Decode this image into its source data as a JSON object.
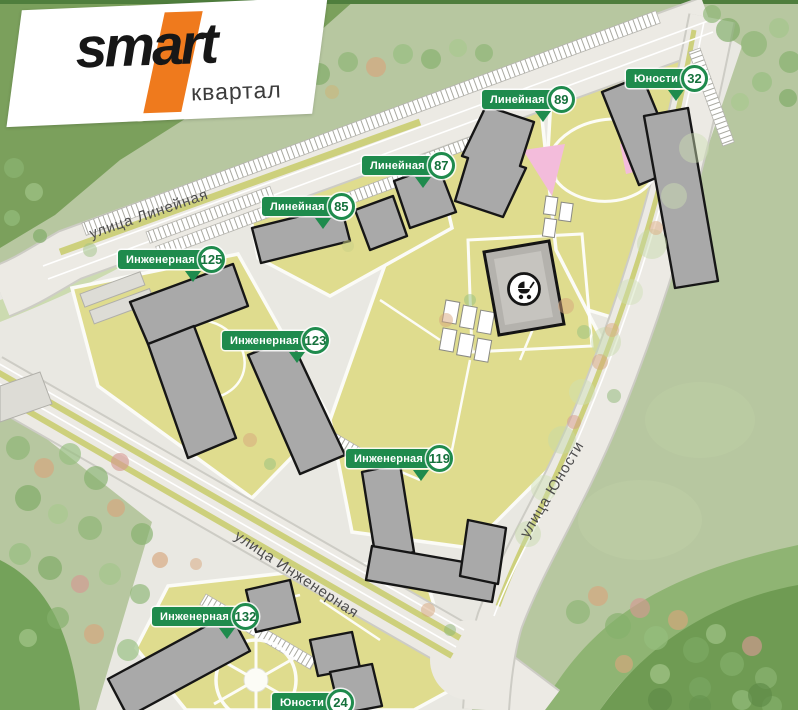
{
  "logo": {
    "brand": "smart",
    "sub": "квартал"
  },
  "markers": [
    {
      "street": "Линейная",
      "number": "89"
    },
    {
      "street": "Юности",
      "number": "32"
    },
    {
      "street": "Линейная",
      "number": "87"
    },
    {
      "street": "Линейная",
      "number": "85"
    },
    {
      "street": "Инженерная",
      "number": "125"
    },
    {
      "street": "Инженерная",
      "number": "123"
    },
    {
      "street": "Инженерная",
      "number": "119"
    },
    {
      "street": "Инженерная",
      "number": "132"
    },
    {
      "street": "Юности",
      "number": "24"
    }
  ],
  "streets": [
    {
      "name": "улица Линейная"
    },
    {
      "name": "улица Инженерная"
    },
    {
      "name": "улица Юности"
    }
  ],
  "icons": {
    "kindergarten": "stroller-icon"
  },
  "colors": {
    "marker_green": "#1f8b4d",
    "brand_orange": "#ef7a1d",
    "courtyard_yellow": "#dfdc8e",
    "road_gray": "#eceae4",
    "building_gray": "#a9a9a9",
    "outside_green": "#7ba05c"
  }
}
